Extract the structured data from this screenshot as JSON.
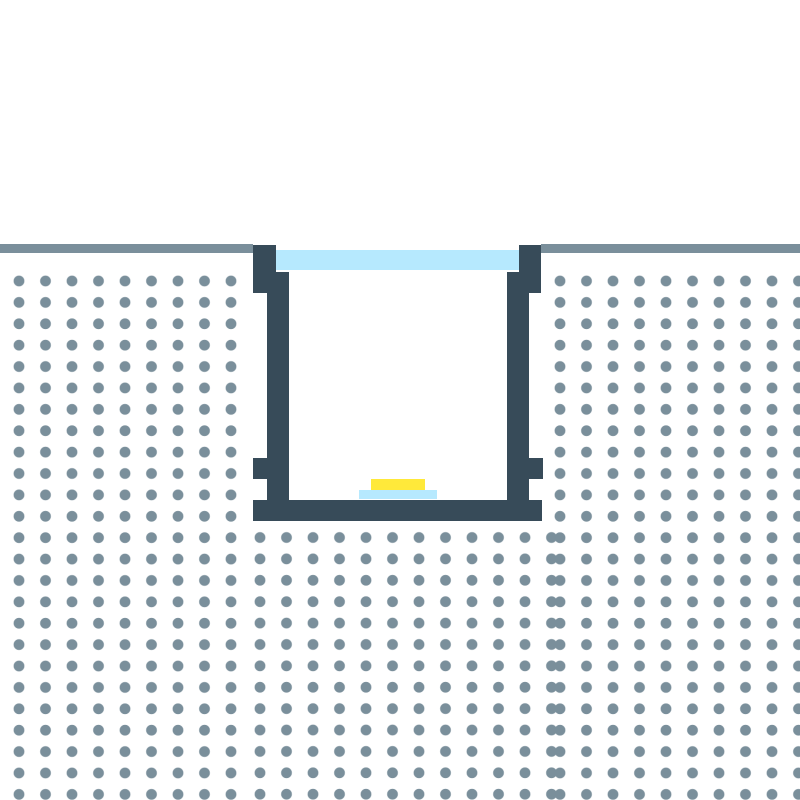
{
  "diagram": {
    "background_color": "#ffffff",
    "colors": {
      "background": "#ffffff",
      "material_dots": "#7a8f9b",
      "surface_line": "#7a8f9b",
      "profile_body": "#374b59",
      "diffuser": "#b6e9fe",
      "led_strip": "#ffe93a",
      "led_base": "#b6e9fe"
    },
    "components": {
      "surface_line_left": "surface line left segment",
      "surface_line_right": "surface line right segment",
      "dotted_material_left": "dotted material field left of channel",
      "dotted_material_right": "dotted material field right of channel",
      "dotted_material_bottom": "dotted material field below channel",
      "channel_flange_left": "channel top flange left",
      "channel_flange_right": "channel top flange right",
      "channel_wall_left": "channel side wall left",
      "channel_wall_right": "channel side wall right",
      "channel_lug_left": "channel mounting lug left",
      "channel_lug_right": "channel mounting lug right",
      "channel_base": "channel bottom base bar",
      "diffuser_cover": "diffuser cover strip",
      "led_strip": "led strip",
      "led_base": "led strip base"
    }
  }
}
